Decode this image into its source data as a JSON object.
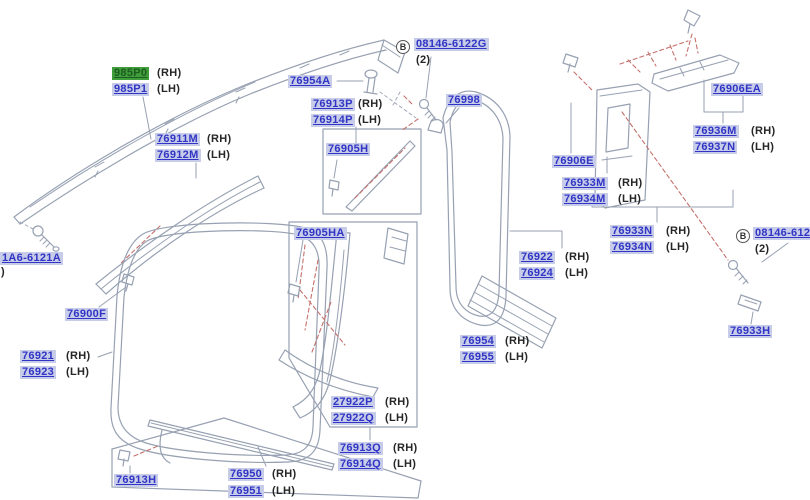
{
  "colors": {
    "label_text": "#3134c5",
    "label_background": "#c7cde8",
    "highlight_background": "#3f9e3b",
    "highlight_text": "#1d5c20",
    "line_art": "#97a1b2",
    "attachment_dash": "#c4716c",
    "plain_text": "#262626"
  },
  "parts": {
    "985P0": "985P0",
    "985P1": "985P1",
    "76911M": "76911M",
    "76912M": "76912M",
    "76954A": "76954A",
    "76913P": "76913P",
    "76914P": "76914P",
    "76905H": "76905H",
    "08146-6122G": "08146-6122G",
    "76998": "76998",
    "76905HA": "76905HA",
    "1A6-6121A": "1A6-6121A",
    "76900F": "76900F",
    "76921": "76921",
    "76923": "76923",
    "76913H": "76913H",
    "76950": "76950",
    "76951": "76951",
    "27922P": "27922P",
    "27922Q": "27922Q",
    "76913Q": "76913Q",
    "76914Q": "76914Q",
    "76954": "76954",
    "76955": "76955",
    "76922": "76922",
    "76924": "76924",
    "76906E": "76906E",
    "76933M": "76933M",
    "76934M": "76934M",
    "76933N": "76933N",
    "76934N": "76934N",
    "76906EA": "76906EA",
    "76936M": "76936M",
    "76937N": "76937N",
    "76933H": "76933H"
  },
  "strings": {
    "rh": "(RH)",
    "lh": "(LH)",
    "qty2": "(2)",
    "bolt_ref": "B",
    "clipped_paren": ")"
  }
}
